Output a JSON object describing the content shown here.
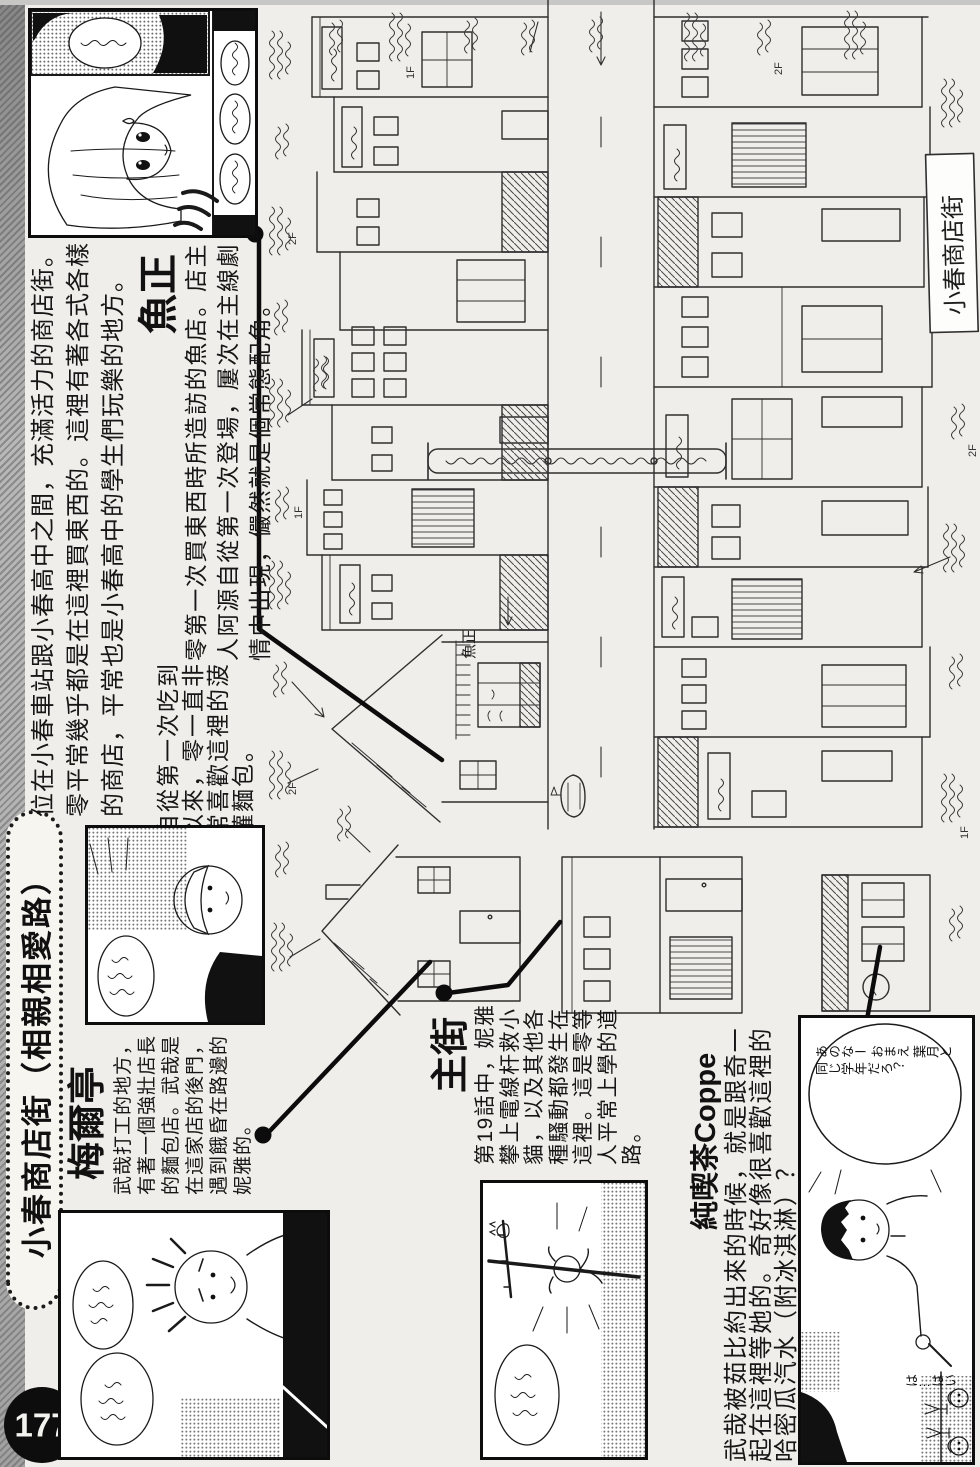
{
  "page_number": "177",
  "title": "小春商店街（相親相愛路）",
  "intro": "位在小春車站跟小春高中之間，充滿活力的商店街。零平常幾乎都是在這裡買東西的。這裡有著各式各樣的商店，平常也是小春高中的學生們玩樂的地方。",
  "sections": {
    "uomasa": {
      "heading": "魚正",
      "body": "零第一次買東西時所造訪的魚店。店主人阿源自從第一次登場，屢次在主線劇情中出現，儼然就是個常態配角。",
      "note": "自從第一次吃到以來，零一直非常喜歡這裡的菠蘿麵包。"
    },
    "merutei": {
      "heading": "梅爾亭",
      "body": "武哉打工的地方，有著一個強壯店長的麵包店。武哉是在這家店的後門，遇到餓昏在路邊的妮雅的。"
    },
    "mainstreet": {
      "heading": "主街",
      "body": "第19話中，妮雅攀上電線杆救小貓，以及其他各種騷動都發生在這裡。這是零等人平常上學的道路。"
    },
    "coppe": {
      "heading": "純喫茶Coppe",
      "body": "武哉被茹比約出來的時候，就是跟奇一起在這裡等她的。奇好像很喜歡這裡的哈密瓜汽水（附冰淇淋）？"
    }
  },
  "map": {
    "sign_box": "小春商店街",
    "fish_shop_sign": "魚正",
    "floor_label_1f": "1F",
    "floor_label_2f": "2F"
  },
  "panel_bubbles": {
    "senpai_line": "あのなー おまえ 葉月と同じ学年だろ？",
    "reply": "は…はい"
  },
  "colors": {
    "paper": "#f0eeea",
    "ink": "#1c1c1c",
    "accent_black": "#0d0d0d"
  }
}
